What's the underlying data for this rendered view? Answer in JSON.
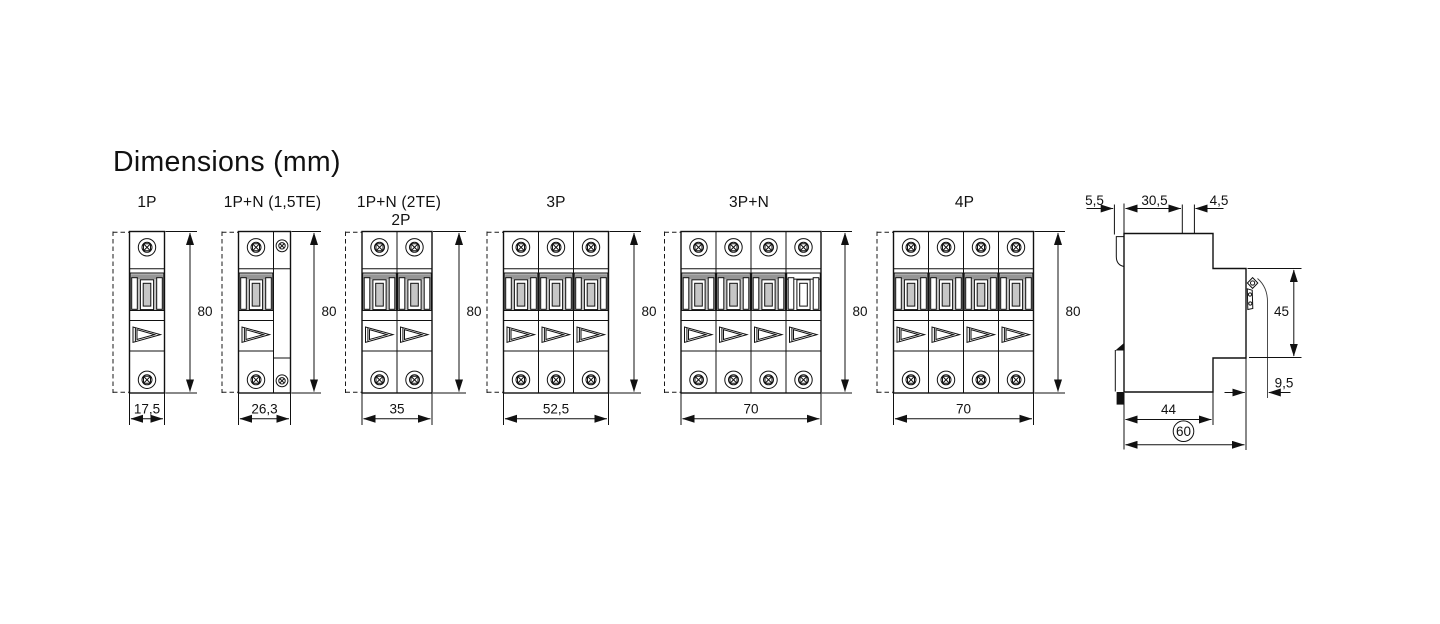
{
  "title": "Dimensions (mm)",
  "views": [
    {
      "label": "1P",
      "height": "80",
      "width": "17,5"
    },
    {
      "label": "1P+N (1,5TE)",
      "height": "80",
      "width": "26,3"
    },
    {
      "label": "1P+N (2TE)",
      "sublabel": "2P",
      "height": "80",
      "width": "35"
    },
    {
      "label": "3P",
      "height": "80",
      "width": "52,5"
    },
    {
      "label": "3P+N",
      "height": "80",
      "width": "70"
    },
    {
      "label": "4P",
      "height": "80",
      "width": "70"
    }
  ],
  "side_view": {
    "rail_hook_depth": "5,5",
    "upper_body_depth": "30,5",
    "front_tab_depth": "4,5",
    "front_height": "45",
    "clip_lever_offset": "9,5",
    "base_depth": "44",
    "total_depth": "60"
  },
  "colors": {
    "line": "#111111",
    "toggle_gray": "#c6c6c6",
    "toggle_dark_gray": "#969696",
    "background": "#ffffff"
  }
}
